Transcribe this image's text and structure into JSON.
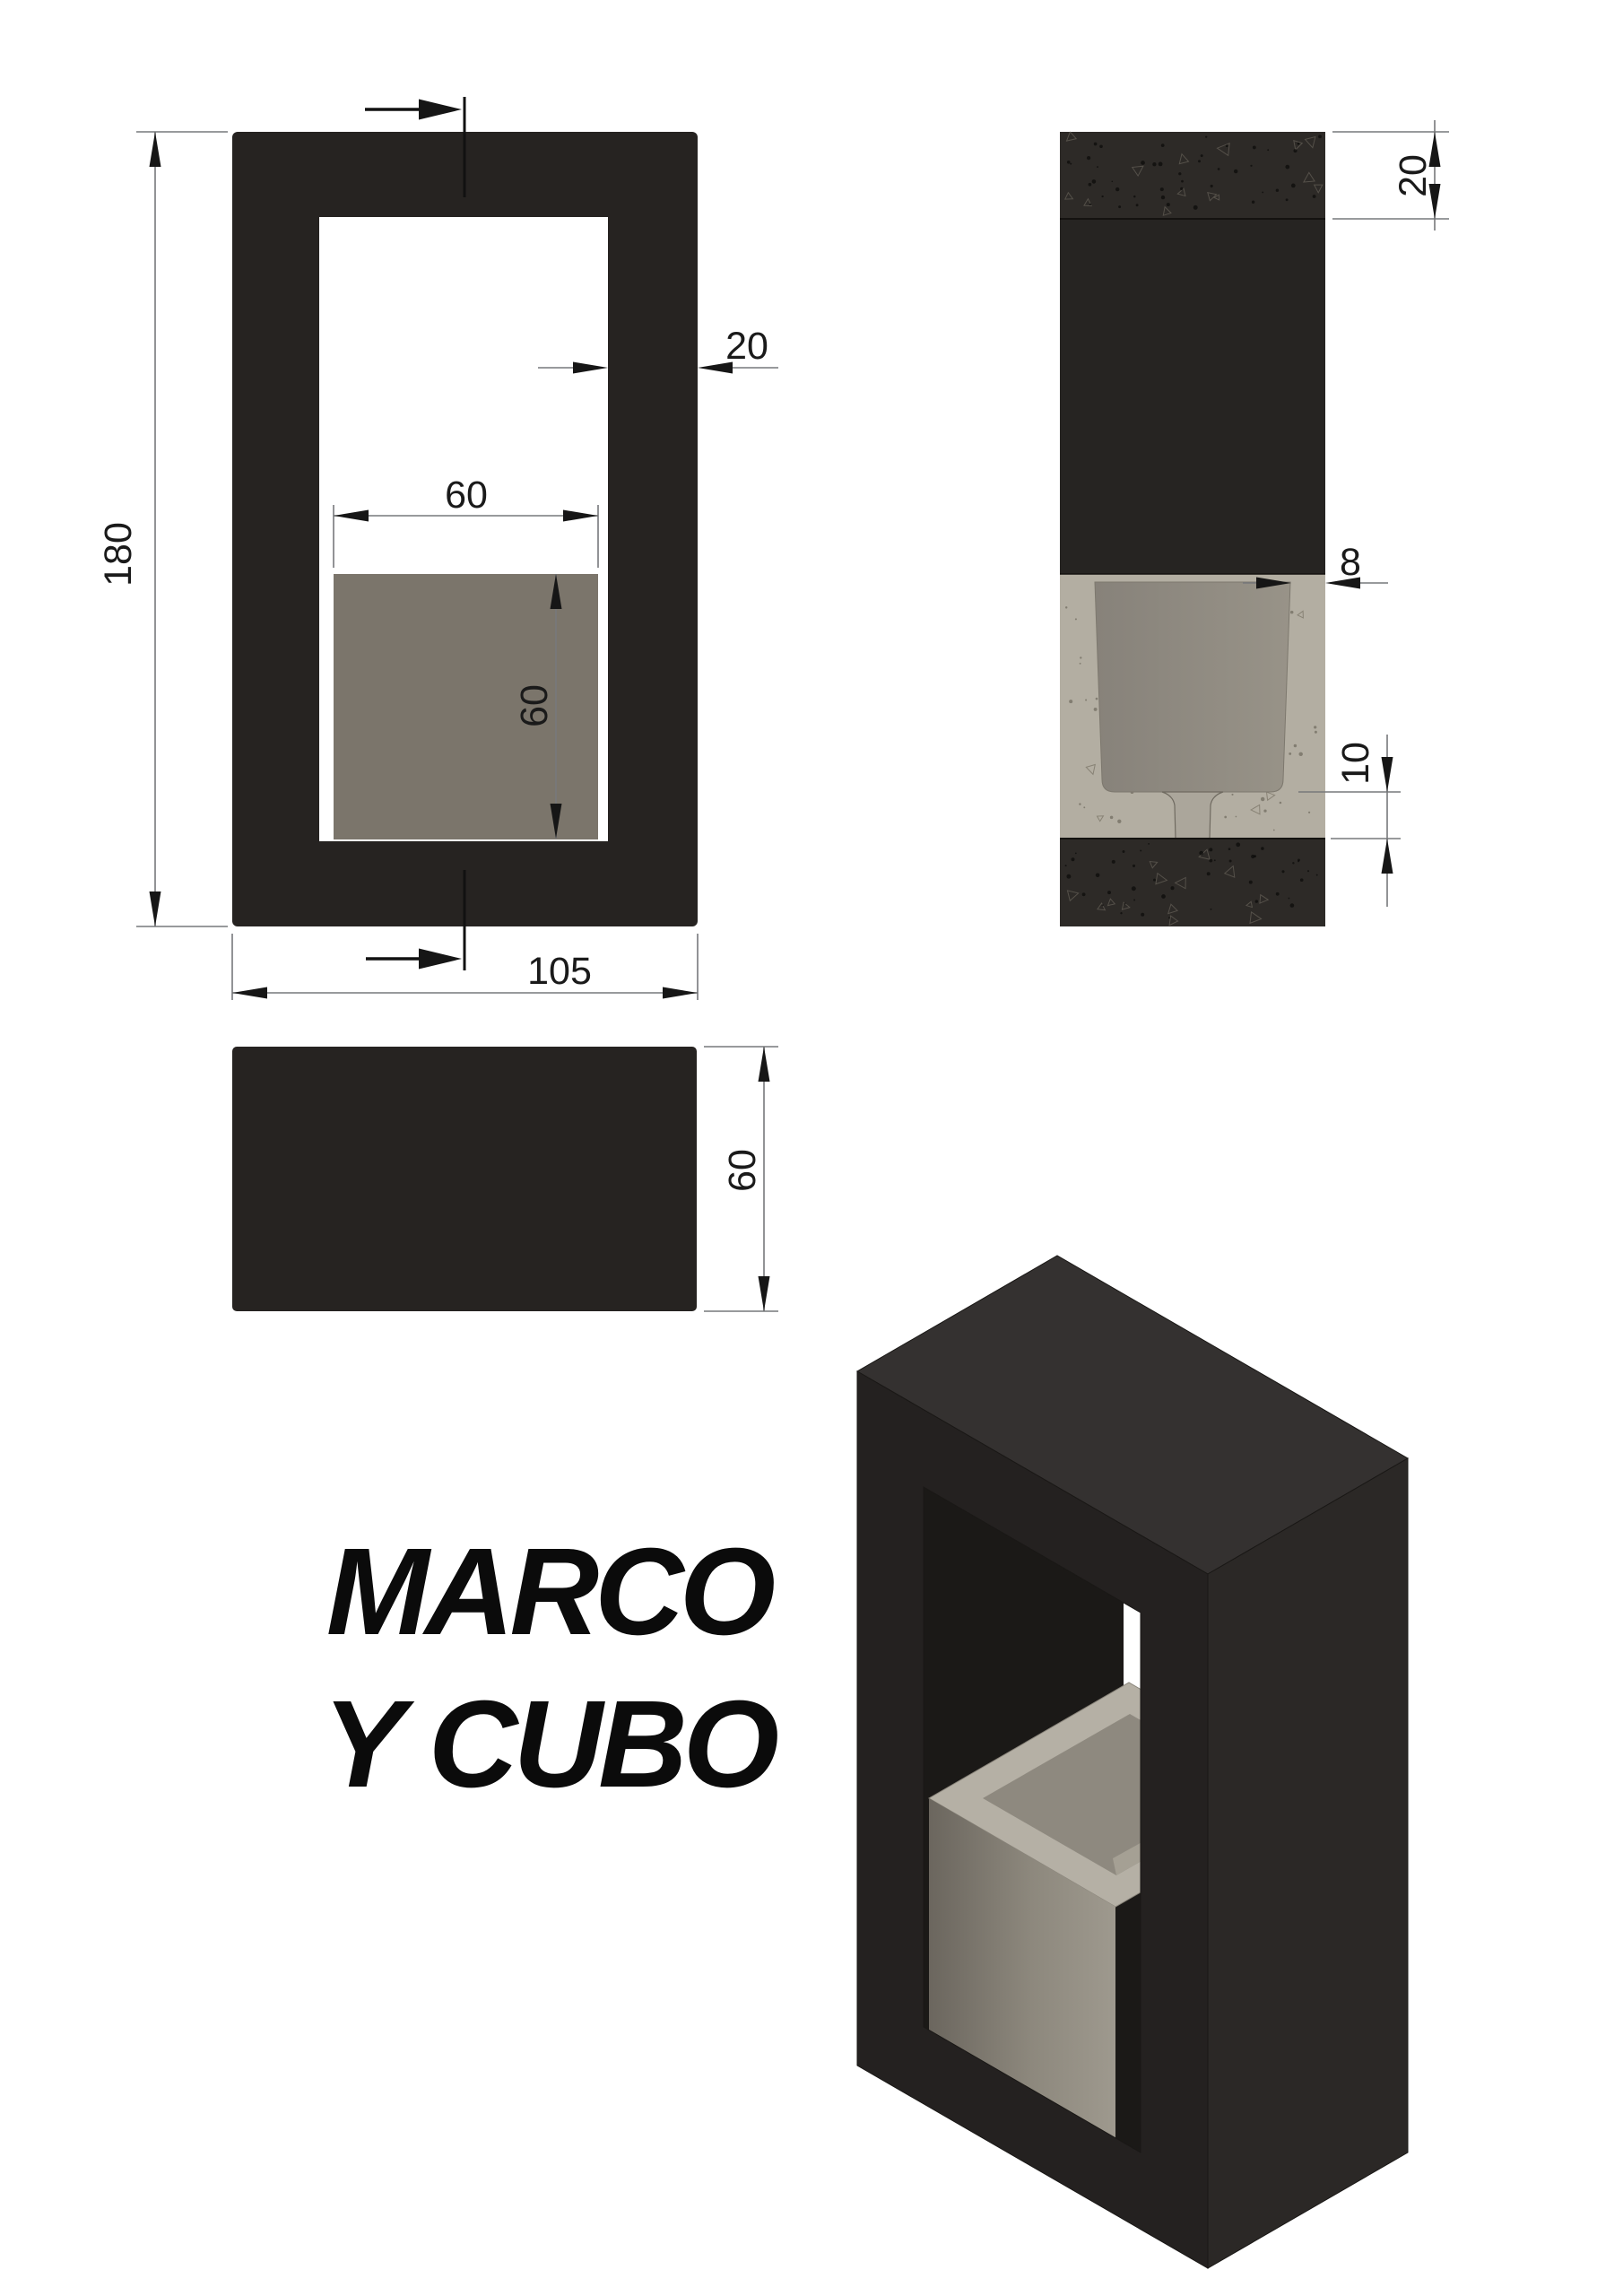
{
  "drawing": {
    "title": {
      "line1": "MARCO",
      "line2": "Y CUBO"
    },
    "dimensions": {
      "front_height": "180",
      "front_width": "105",
      "front_wall": "20",
      "cube_width": "60",
      "cube_height": "60",
      "side_top_wall": "20",
      "cube_wall": "8",
      "cube_floor": "10",
      "top_depth": "60"
    },
    "colors": {
      "background": "#ffffff",
      "frame_dark": "#262321",
      "frame_side": "#262422",
      "band_texture": "#2d2a27",
      "cube_gray": "#7b756b",
      "concrete_cut": "#b3aea2",
      "cavity": "#a49f94",
      "funnel": "#aba69b",
      "iso_top": "#343130",
      "iso_front": "#242120",
      "iso_right": "#2b2826",
      "iso_interior": "#1b1917",
      "iso_cube_rim": "#b5b0a5",
      "iso_cavity": "#8e897f",
      "dim_line": "#77787b",
      "dim_text": "#1a1a1a"
    }
  }
}
